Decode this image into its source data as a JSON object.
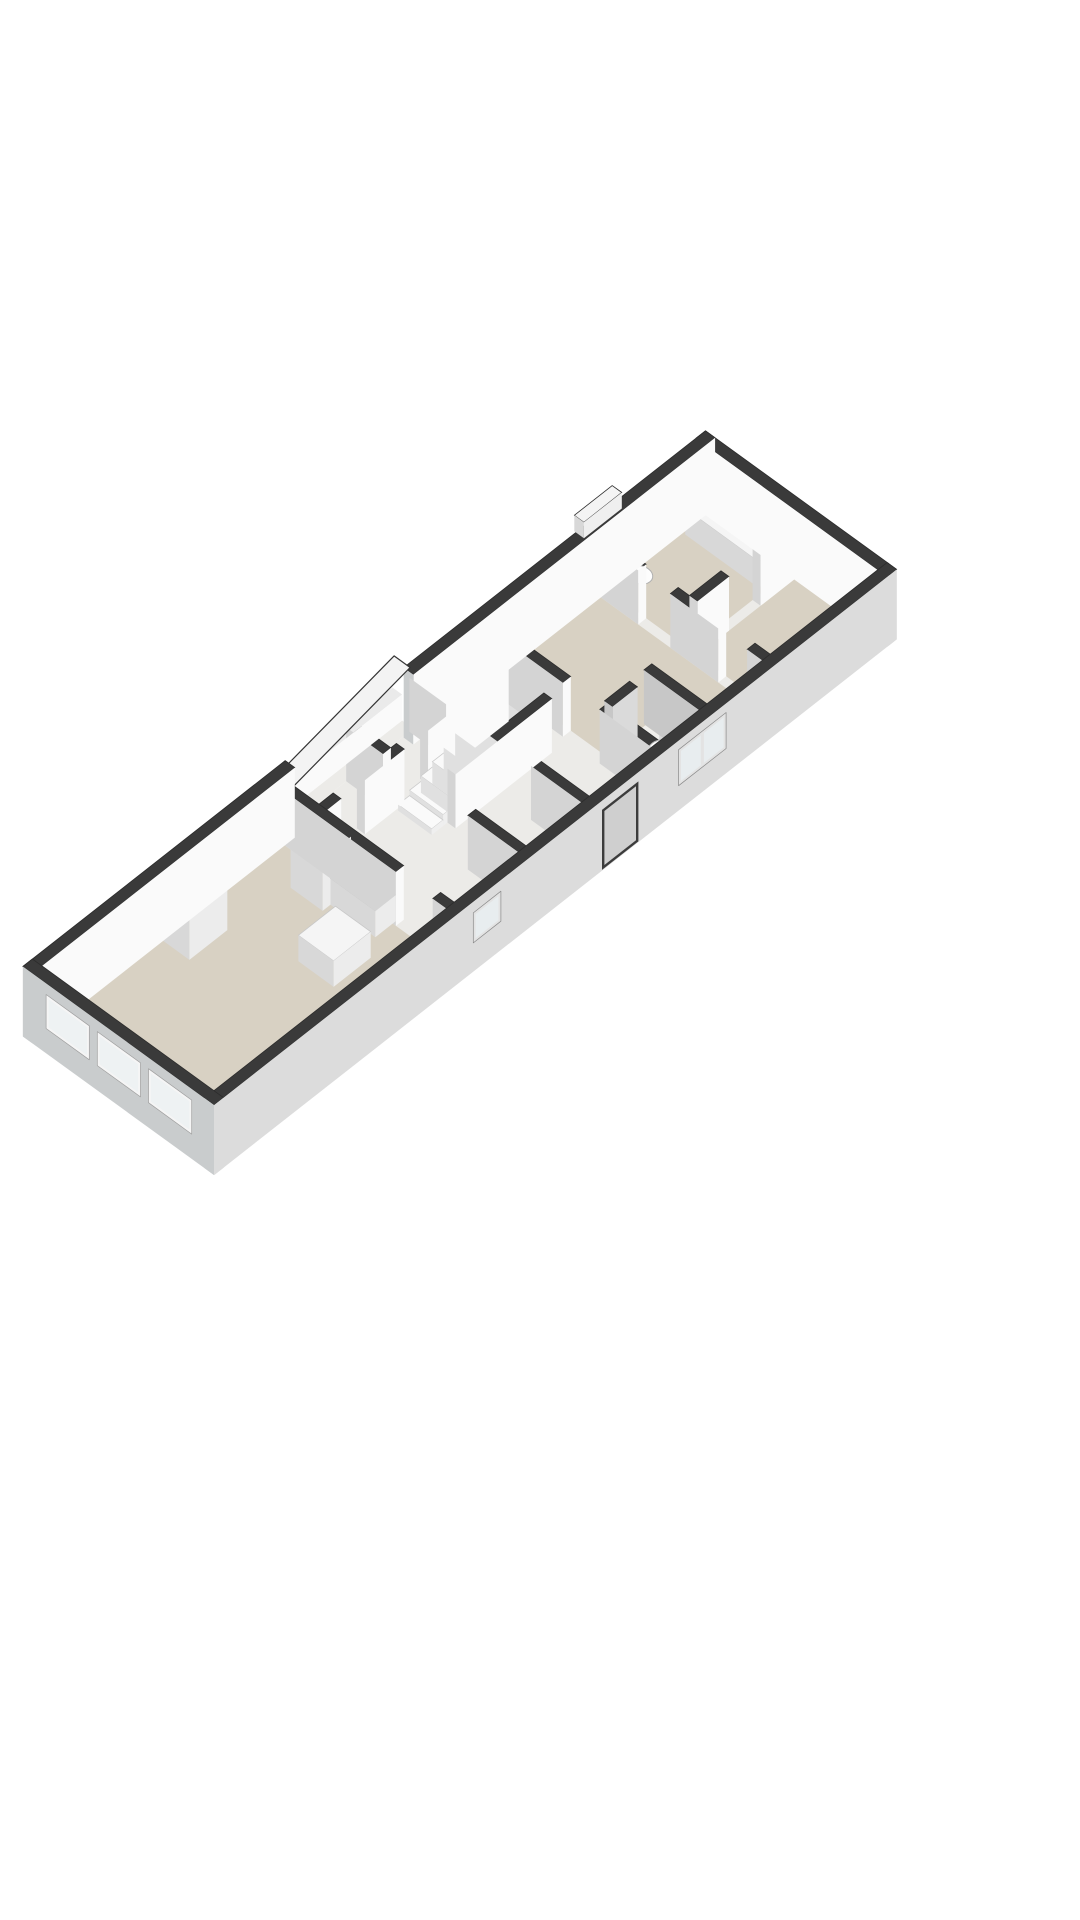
{
  "page": {
    "background": "#ffffff"
  },
  "palette": {
    "wallTop": "#3a3a3a",
    "edge": "#2c2c2c",
    "wallFace": "#fafafa",
    "wallShade": "#d4d4d4",
    "facadeFront": "#dcdcdc",
    "facadeWest": "#c9cccd",
    "floorBase": "#ecebe8",
    "floorBeige": "#d8d1c3",
    "floorWC": "#f0efec",
    "glass": "#e8edef",
    "glassWest": "#eef2f3",
    "frame": "#f5f5f5",
    "frameFront": "#e3e3e3",
    "frameStroke": "#9f9f9f",
    "stepTop": "#fafafa",
    "stepFront": "#efefef",
    "stepLeft": "#e0e0e0",
    "counterTop": "#f5f5f5",
    "counterFront": "#ececec",
    "counterLeft": "#d8d8d8",
    "cooktop": "#2b2b2b",
    "fixture": "#fdfdfd",
    "fixtureInner": "#e6e6e6",
    "fixtureStroke": "#b0b0b0",
    "threshold": "#3e3e3e",
    "roof": "#f3f3f3",
    "annexSide": "#dcdcdc",
    "doorDark": "#3c3c3c",
    "doorLeaf": "#cfcfcf"
  },
  "floorplan": {
    "view": "3d-axonometric",
    "level": "single-floor",
    "rooms": [
      {
        "name": "living-room-with-kitchen",
        "floor": "beige"
      },
      {
        "name": "hallway-with-staircase",
        "floor": "light-gray"
      },
      {
        "name": "storage-closets",
        "floor": "light-gray"
      },
      {
        "name": "front-rooms",
        "floor": "light-gray"
      },
      {
        "name": "middle-bedroom",
        "floor": "beige"
      },
      {
        "name": "wc",
        "floor": "light-gray"
      },
      {
        "name": "end-bedroom",
        "floor": "beige"
      },
      {
        "name": "end-bathroom",
        "floor": "beige"
      }
    ],
    "fixtures": [
      "staircase",
      "kitchen-tall-cabinet",
      "kitchen-counter",
      "kitchen-sink",
      "kitchen-island-with-cooktop",
      "chimney-block",
      "bathroom-toilet",
      "bathroom-washbasin-counter",
      "wc-toilet",
      "entrance-door",
      "back-annex-sloped-roof",
      "roof-box"
    ],
    "window_count": 7
  }
}
